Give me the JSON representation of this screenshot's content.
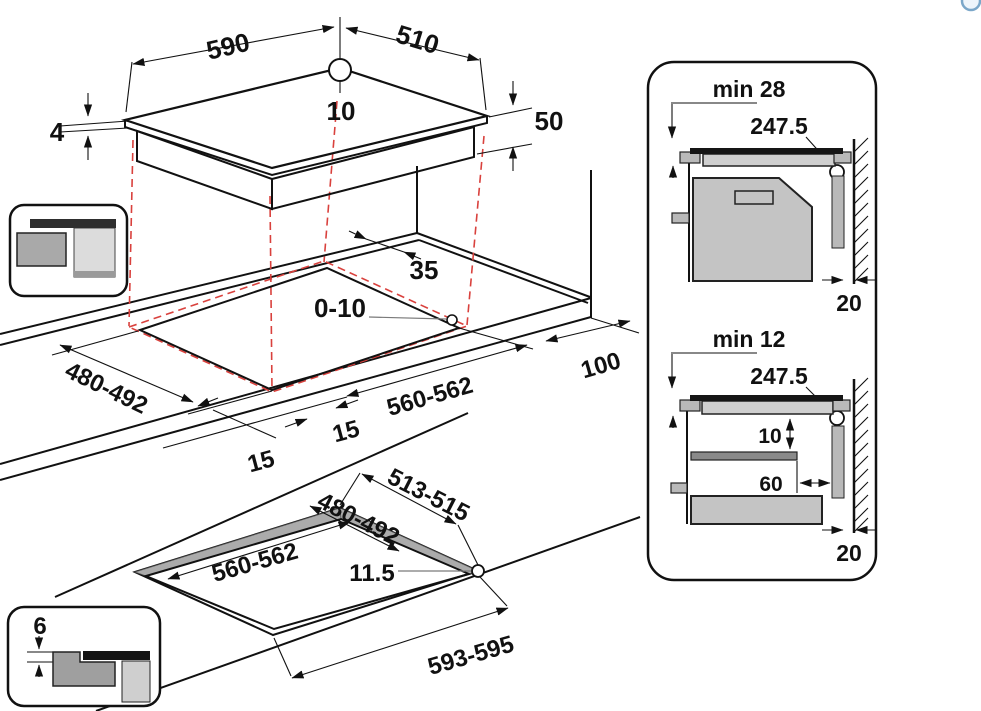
{
  "colors": {
    "line": "#111111",
    "projection_red": "#d9413d",
    "leader_gray": "#7a7a7a",
    "fill_light_gray": "#c9c9c9",
    "fill_mid_gray": "#ababab",
    "glass_black": "#151515",
    "icon_blue": "#7ba7c9"
  },
  "hob": {
    "width_mm": "590",
    "depth_mm": "510",
    "hole_diameter_mm": "10",
    "glass_thickness_mm": "4",
    "body_height_mm": "50"
  },
  "worktop": {
    "rear_gap_mm": "35",
    "hole_offset_range_mm": "0-10",
    "cutout_depth_range_mm": "480-492",
    "left_clearance_mm": "15",
    "right_clearance_mm": "15",
    "cutout_width_range_mm": "560-562",
    "side_clearance_mm": "100"
  },
  "flush": {
    "recess_depth_range_mm": "513-515",
    "cutout_depth_range_mm": "480-492",
    "cutout_width_range_mm": "560-562",
    "hole_offset_mm": "11.5",
    "recess_width_range_mm": "593-595",
    "recess_step_mm": "6"
  },
  "clearance_oven": {
    "min_top": "min 28",
    "hole_center": "247.5",
    "wall_gap": "20"
  },
  "clearance_drawer": {
    "min_top": "min 12",
    "hole_center": "247.5",
    "shelf_gap": "10",
    "shelf_setback": "60",
    "wall_gap": "20"
  }
}
